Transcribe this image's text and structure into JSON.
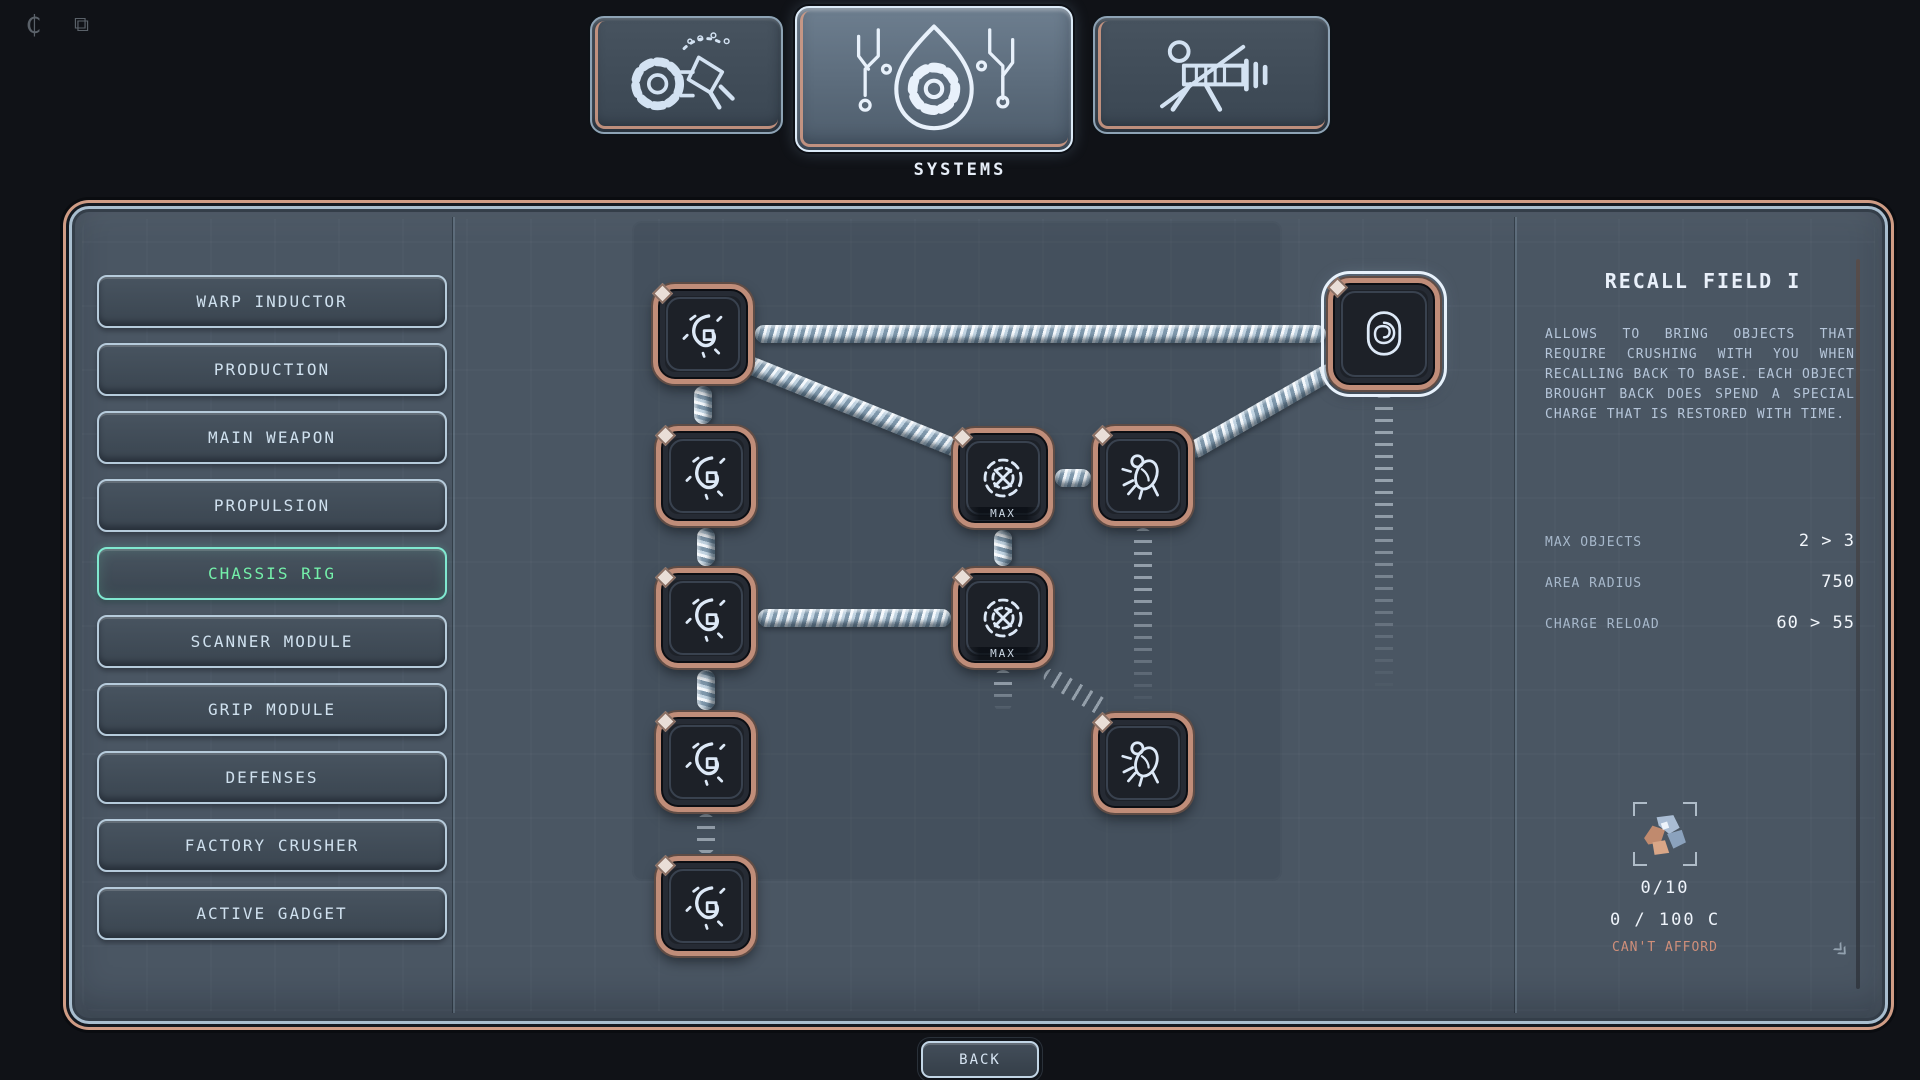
{
  "topbar": {
    "icons": [
      {
        "name": "credits-icon",
        "glyph": "₵"
      },
      {
        "name": "expand-icon",
        "glyph": "⧉"
      }
    ]
  },
  "tabs": {
    "items": [
      {
        "id": "fabrication",
        "icon": "drill-arm-icon",
        "selected": false,
        "label": ""
      },
      {
        "id": "systems",
        "icon": "gear-drop-icon",
        "selected": true,
        "label": "SYSTEMS"
      },
      {
        "id": "weapons",
        "icon": "raygun-icon",
        "selected": false,
        "label": ""
      }
    ]
  },
  "sidebar": {
    "items": [
      {
        "label": "WARP INDUCTOR",
        "selected": false
      },
      {
        "label": "PRODUCTION",
        "selected": false
      },
      {
        "label": "MAIN WEAPON",
        "selected": false
      },
      {
        "label": "PROPULSION",
        "selected": false
      },
      {
        "label": "CHASSIS RIG",
        "selected": true
      },
      {
        "label": "SCANNER MODULE",
        "selected": false
      },
      {
        "label": "GRIP MODULE",
        "selected": false
      },
      {
        "label": "DEFENSES",
        "selected": false
      },
      {
        "label": "FACTORY CRUSHER",
        "selected": false
      },
      {
        "label": "ACTIVE GADGET",
        "selected": false
      }
    ]
  },
  "tree": {
    "nodes": [
      {
        "id": "node-1",
        "icon": "rune-icon",
        "state": "purchased",
        "badge": ""
      },
      {
        "id": "node-2",
        "icon": "rune-icon",
        "state": "purchased",
        "badge": ""
      },
      {
        "id": "node-3",
        "icon": "rune-icon",
        "state": "purchased",
        "badge": ""
      },
      {
        "id": "node-4",
        "icon": "rune-icon",
        "state": "purchased",
        "badge": ""
      },
      {
        "id": "node-5",
        "icon": "rune-icon",
        "state": "purchased",
        "badge": ""
      },
      {
        "id": "node-6",
        "icon": "radar-icon",
        "state": "purchased",
        "badge": "MAX"
      },
      {
        "id": "node-7",
        "icon": "radar-icon",
        "state": "purchased",
        "badge": "MAX"
      },
      {
        "id": "node-8",
        "icon": "bug-icon",
        "state": "purchased",
        "badge": ""
      },
      {
        "id": "node-9",
        "icon": "bug-icon",
        "state": "purchased",
        "badge": ""
      },
      {
        "id": "node-10",
        "icon": "spiral-icon",
        "state": "selected",
        "badge": ""
      }
    ]
  },
  "detail": {
    "title": "RECALL FIELD I",
    "description": "ALLOWS TO BRING OBJECTS THAT REQUIRE CRUSHING WITH YOU WHEN RECALLING BACK TO BASE. EACH OBJECT BROUGHT BACK DOES SPEND A SPECIAL CHARGE THAT IS RESTORED WITH TIME.",
    "stats": [
      {
        "label": "MAX OBJECTS",
        "value": "2 > 3"
      },
      {
        "label": "AREA RADIUS",
        "value": "750"
      },
      {
        "label": "CHARGE RELOAD",
        "value": "60 > 55"
      }
    ],
    "cost": {
      "resource_count": "0/10",
      "credits": "0 / 100 C",
      "status": "CAN'T AFFORD"
    }
  },
  "footer": {
    "back_label": "BACK"
  },
  "colors": {
    "accent_salmon": "#cf9c85",
    "accent_green": "#74f0aa",
    "accent_teal": "#80e8d0",
    "panel": "#4a5663",
    "cant_afford": "#d08f7a"
  }
}
